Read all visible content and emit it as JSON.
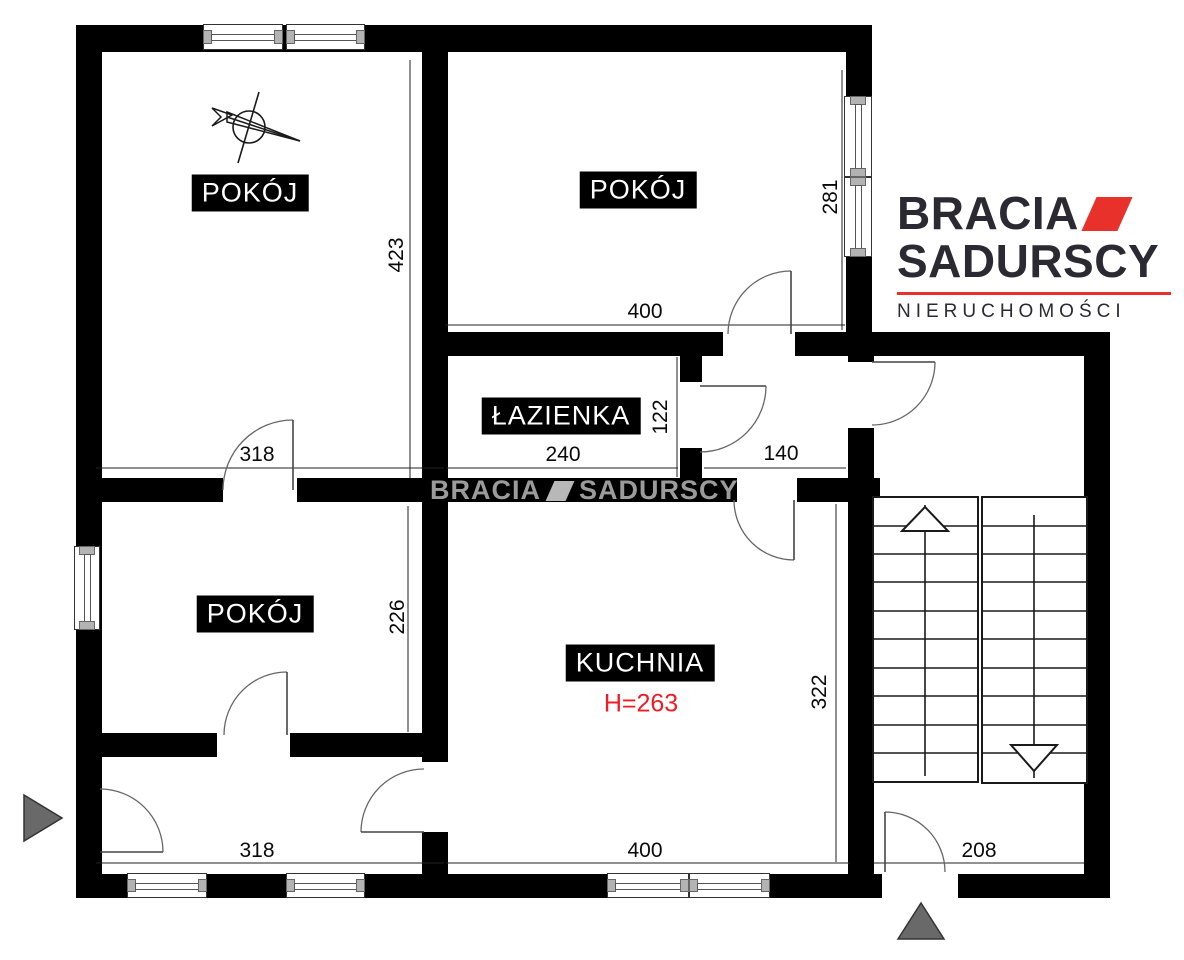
{
  "plan": {
    "rooms": {
      "pokoj1": "POKÓJ",
      "pokoj2": "POKÓJ",
      "lazienka": "ŁAZIENKA",
      "pokoj3": "POKÓJ",
      "kuchnia": "KUCHNIA",
      "kuchnia_height": "H=263"
    },
    "dims": {
      "pokoj1_h": "423",
      "pokoj2_h": "281",
      "pokoj2_w": "400",
      "pokoj1_w": "318",
      "lazienka_w": "240",
      "lazienka_h": "122",
      "korytarz_w": "140",
      "pokoj3_h": "226",
      "kuchnia_h": "322",
      "przedpokoj_w": "318",
      "kuchnia_w": "400",
      "wejscie_w": "208"
    }
  },
  "watermark": {
    "word1": "BRACIA",
    "word2": "SADURSCY"
  },
  "logo": {
    "word1": "BRACIA",
    "word2": "SADURSCY",
    "tagline": "NIERUCHOMOŚCI"
  },
  "colors": {
    "wall": "#000000",
    "logo_dark": "#2b2a33",
    "logo_red": "#e8312a",
    "height_red": "#ee1c25",
    "watermark_gray": "#a7a7a7",
    "triangle_gray": "#6a6a6a"
  }
}
